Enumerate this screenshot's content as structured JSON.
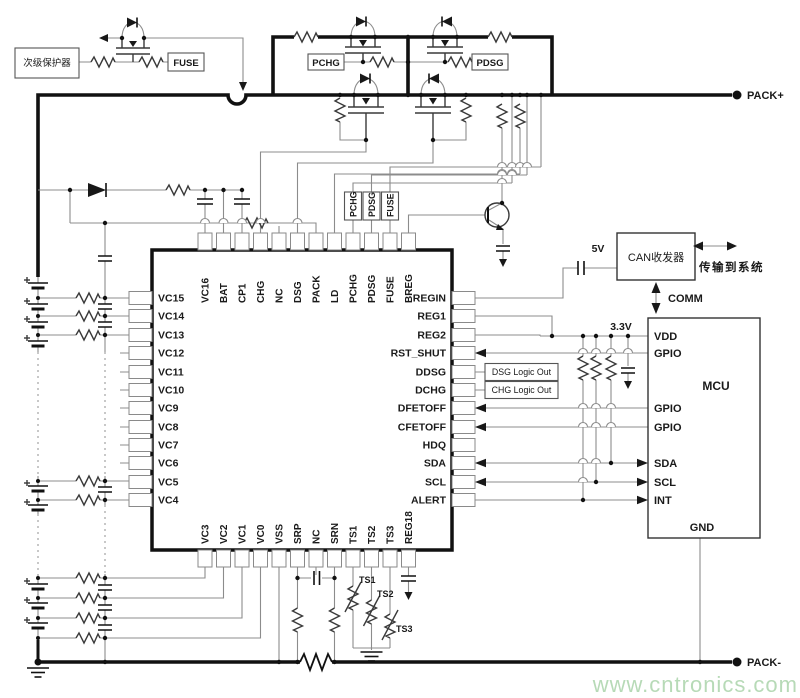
{
  "schematic": {
    "protector": {
      "label": "次级保护器",
      "fuse": "FUSE"
    },
    "precharge": {
      "pchg": "PCHG",
      "pdsg": "PDSG"
    },
    "afe": {
      "top_pins": [
        "VC16",
        "BAT",
        "CP1",
        "CHG",
        "NC",
        "DSG",
        "PACK",
        "LD",
        "PCHG",
        "PDSG",
        "FUSE",
        "BREG"
      ],
      "left_pins": [
        "VC15",
        "VC14",
        "VC13",
        "VC12",
        "VC11",
        "VC10",
        "VC9",
        "VC8",
        "VC7",
        "VC6",
        "VC5",
        "VC4"
      ],
      "right_pins": [
        "REGIN",
        "REG1",
        "REG2",
        "RST_SHUT",
        "DDSG",
        "DCHG",
        "DFETOFF",
        "CFETOFF",
        "HDQ",
        "SDA",
        "SCL",
        "ALERT"
      ],
      "bottom_pins": [
        "VC3",
        "VC2",
        "VC1",
        "VC0",
        "VSS",
        "SRP",
        "NC",
        "SRN",
        "TS1",
        "TS2",
        "TS3",
        "REG18"
      ],
      "gate_boxes": [
        "PCHG",
        "PDSG",
        "FUSE"
      ]
    },
    "logic": {
      "dsg": "DSG Logic Out",
      "chg": "CHG Logic Out"
    },
    "power": {
      "v5": "5V",
      "v33": "3.3V",
      "pack_plus": "PACK+",
      "pack_minus": "PACK-"
    },
    "mcu": {
      "name": "MCU",
      "pins": [
        "VDD",
        "GPIO",
        "GPIO",
        "GPIO",
        "SDA",
        "SCL",
        "INT"
      ],
      "gnd": "GND"
    },
    "can": {
      "label": "CAN收发器",
      "to_system": "传输到系统",
      "comm": "COMM"
    },
    "thermistors": [
      "TS1",
      "TS2",
      "TS3"
    ],
    "watermark": "www.cntronics.com",
    "colors": {
      "wire": "#8c8c8c",
      "rail": "#111111",
      "watermark": "#b7dab7"
    }
  }
}
